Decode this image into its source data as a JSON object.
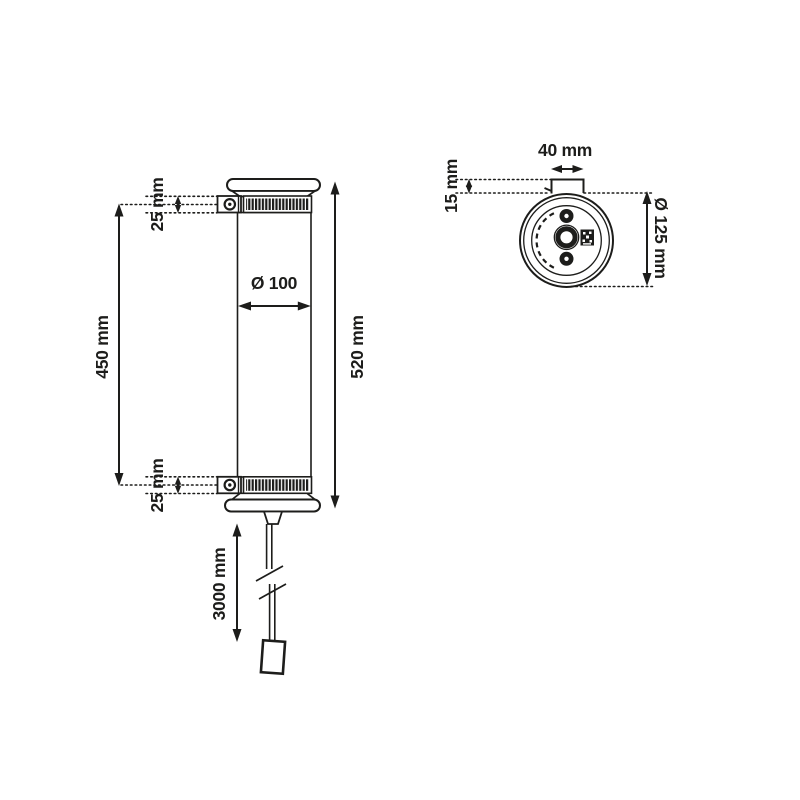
{
  "drawing_type": "technical dimension drawing, wall tube lamp, front view and top view",
  "colors": {
    "line": "#1d1d1b",
    "background": "#ffffff"
  },
  "front_view": {
    "clamp_top_label": "25 mm",
    "clamp_bottom_label": "25 mm",
    "fixing_centers_label": "450 mm",
    "total_height_label": "520 mm",
    "tube_diameter_label": "Ø 100",
    "cable_length_label": "3000 mm"
  },
  "top_view": {
    "bracket_width_label": "40 mm",
    "bracket_depth_label": "15 mm",
    "body_diameter_label": "Ø 125 mm"
  }
}
